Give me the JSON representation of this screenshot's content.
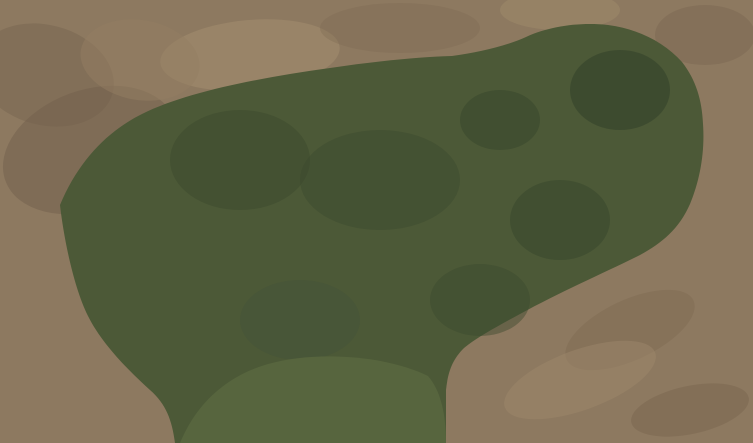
{
  "scene_meta": {
    "description": "aerial-drone-photo-of-landscaped-estate",
    "width": 753,
    "height": 443
  },
  "palette": {
    "dirt_base": "#8d7960",
    "dirt_light": "#9c8a72",
    "dirt_dark": "#6f5d4b",
    "dirt_road": "#948062",
    "dirt_track": "#a8926f",
    "estate_green": "#4c5937",
    "lawn_light": "#57653e",
    "scrub_dark": "#4f5140",
    "hedge": "#2b3b25",
    "tree_dark": "#33462b",
    "tree_mid": "#42582f",
    "tree_olive": "#6b7548",
    "shrub_bare": "#84765f",
    "tall_grass": "#b2a277",
    "tall_grass_light": "#d3c79c",
    "water": "#3a444e",
    "water_deep": "#313a43",
    "cascade_blue": "#8fb3cc",
    "stone_path": "#c8cdd2",
    "stone_white": "#e9ebed",
    "paving_gray": "#a7adb4",
    "flower_pink": "#c2447e",
    "pavilion_navy": "#1b2341",
    "pavilion_rib": "#2a3560",
    "cream_roof": "#e9e2d0",
    "cream_parapet": "#f2efe6",
    "cream_shadow": "#5a4038",
    "play_blue": "#3a79b8",
    "play_green": "#3f9a5f",
    "play_red": "#bf4038",
    "play_salmon": "#dd8a6d",
    "play_teal": "#1f6f74",
    "track_blue": "#7b90a8",
    "track_edge": "#d8dde2",
    "villa_roof": "#49525c",
    "villa_roof_hip": "#6a7581",
    "villa_border": "#dcdfe2",
    "villa_tan": "#cfc3a6",
    "villa_glass": "#a8c8dc",
    "bigroof_a": "#566779",
    "bigroof_b": "#73859a",
    "bigroof_c": "#5d6e82",
    "facade": "#3a4a5c",
    "window_glass": "#7c96aa",
    "canopy_glass": "#54738c",
    "house_roof": "#535d66",
    "house_ridge": "#76828c",
    "court_pave": "#c6cacf",
    "court_alt": "#b2b8bf",
    "asphalt": "#45494d",
    "curb": "#c9cccd",
    "parking_gray": "#8e9092",
    "spa_dark": "#25424a",
    "teal_paint": "#3aa08a",
    "white": "#ffffff"
  },
  "scene": {
    "bushes": [
      [
        175,
        100,
        8,
        "d"
      ],
      [
        192,
        88,
        6,
        "b"
      ],
      [
        210,
        95,
        9,
        "m"
      ],
      [
        228,
        82,
        7,
        "d"
      ],
      [
        246,
        92,
        8,
        "b"
      ],
      [
        262,
        80,
        7,
        "m"
      ],
      [
        280,
        88,
        8,
        "d"
      ],
      [
        298,
        78,
        6,
        "b"
      ],
      [
        315,
        85,
        7,
        "m"
      ],
      [
        332,
        76,
        6,
        "d"
      ],
      [
        350,
        84,
        8,
        "b"
      ],
      [
        368,
        70,
        7,
        "m"
      ],
      [
        385,
        80,
        6,
        "d"
      ],
      [
        402,
        72,
        7,
        "b"
      ],
      [
        418,
        78,
        6,
        "m"
      ],
      [
        433,
        70,
        5,
        "d"
      ],
      [
        448,
        64,
        6,
        "b"
      ],
      [
        460,
        72,
        6,
        "m"
      ],
      [
        415,
        96,
        7,
        "o"
      ],
      [
        396,
        101,
        6,
        "d"
      ],
      [
        425,
        107,
        7,
        "m"
      ],
      [
        512,
        54,
        8,
        "d"
      ],
      [
        498,
        44,
        6,
        "m"
      ],
      [
        532,
        44,
        7,
        "d"
      ],
      [
        548,
        36,
        9,
        "d"
      ],
      [
        568,
        29,
        7,
        "m"
      ],
      [
        590,
        31,
        9,
        "d"
      ],
      [
        615,
        30,
        7,
        "m"
      ],
      [
        640,
        38,
        8,
        "d"
      ],
      [
        663,
        52,
        9,
        "m"
      ],
      [
        682,
        68,
        8,
        "d"
      ],
      [
        694,
        90,
        8,
        "m"
      ],
      [
        700,
        112,
        7,
        "d"
      ],
      [
        585,
        60,
        9,
        "d"
      ],
      [
        612,
        52,
        7,
        "m"
      ],
      [
        650,
        58,
        8,
        "d"
      ],
      [
        673,
        95,
        8,
        "m"
      ],
      [
        668,
        124,
        7,
        "d"
      ],
      [
        600,
        140,
        8,
        "m"
      ],
      [
        577,
        126,
        7,
        "d"
      ],
      [
        563,
        100,
        7,
        "m"
      ],
      [
        571,
        76,
        7,
        "b"
      ],
      [
        702,
        150,
        8,
        "o"
      ],
      [
        714,
        170,
        7,
        "d"
      ],
      [
        700,
        214,
        9,
        "m"
      ],
      [
        674,
        238,
        8,
        "d"
      ],
      [
        646,
        252,
        7,
        "m"
      ],
      [
        612,
        256,
        8,
        "d"
      ],
      [
        586,
        264,
        7,
        "m"
      ],
      [
        588,
        176,
        7,
        "d"
      ],
      [
        596,
        200,
        6,
        "m"
      ],
      [
        601,
        224,
        7,
        "d"
      ],
      [
        449,
        150,
        7,
        "m"
      ],
      [
        441,
        176,
        8,
        "d"
      ],
      [
        446,
        202,
        7,
        "m"
      ],
      [
        453,
        226,
        7,
        "d"
      ],
      [
        471,
        251,
        8,
        "d"
      ],
      [
        496,
        263,
        7,
        "m"
      ],
      [
        521,
        271,
        8,
        "d"
      ],
      [
        547,
        279,
        7,
        "m"
      ],
      [
        472,
        291,
        9,
        "d"
      ],
      [
        501,
        296,
        8,
        "m"
      ],
      [
        531,
        301,
        7,
        "d"
      ],
      [
        556,
        290,
        7,
        "m"
      ],
      [
        215,
        350,
        9,
        "d"
      ],
      [
        240,
        366,
        7,
        "m"
      ],
      [
        226,
        396,
        8,
        "o"
      ],
      [
        252,
        421,
        9,
        "d"
      ],
      [
        302,
        401,
        6,
        "m"
      ],
      [
        322,
        381,
        5,
        "d"
      ],
      [
        210,
        431,
        7,
        "m"
      ],
      [
        266,
        391,
        6,
        "d"
      ],
      [
        152,
        150,
        7,
        "m"
      ],
      [
        136,
        170,
        6,
        "d"
      ],
      [
        252,
        120,
        8,
        "m"
      ],
      [
        272,
        108,
        6,
        "d"
      ],
      [
        462,
        321,
        8,
        "d"
      ],
      [
        442,
        341,
        7,
        "m"
      ],
      [
        466,
        346,
        6,
        "o"
      ],
      [
        486,
        330,
        7,
        "d"
      ],
      [
        286,
        346,
        6,
        "d"
      ],
      [
        311,
        351,
        5,
        "m"
      ],
      [
        334,
        340,
        5,
        "d"
      ],
      [
        706,
        60,
        7,
        "b"
      ],
      [
        722,
        200,
        6,
        "d"
      ],
      [
        736,
        90,
        6,
        "b"
      ]
    ],
    "flowers": [
      [
        173,
        168
      ],
      [
        168,
        182
      ],
      [
        171,
        196
      ],
      [
        179,
        210
      ],
      [
        191,
        222
      ],
      [
        205,
        230
      ],
      [
        220,
        234
      ],
      [
        293,
        197
      ],
      [
        301,
        209
      ],
      [
        309,
        221
      ],
      [
        316,
        231
      ],
      [
        252,
        228
      ],
      [
        263,
        235
      ],
      [
        346,
        148
      ],
      [
        353,
        156
      ],
      [
        429,
        92
      ],
      [
        437,
        98
      ],
      [
        301,
        239
      ],
      [
        287,
        243
      ],
      [
        409,
        227
      ],
      [
        417,
        233
      ],
      [
        238,
        131
      ],
      [
        230,
        142
      ]
    ],
    "rocks": [
      [
        196,
        146
      ],
      [
        210,
        140
      ],
      [
        226,
        138
      ],
      [
        244,
        144
      ],
      [
        258,
        152
      ],
      [
        266,
        166
      ],
      [
        262,
        180
      ],
      [
        268,
        196
      ],
      [
        272,
        212
      ],
      [
        258,
        224
      ],
      [
        240,
        230
      ],
      [
        222,
        230
      ],
      [
        206,
        224
      ],
      [
        192,
        214
      ],
      [
        186,
        198
      ],
      [
        184,
        182
      ],
      [
        305,
        130
      ],
      [
        322,
        124
      ],
      [
        340,
        126
      ],
      [
        358,
        130
      ],
      [
        376,
        136
      ],
      [
        394,
        142
      ],
      [
        410,
        148
      ],
      [
        424,
        158
      ],
      [
        432,
        172
      ],
      [
        428,
        186
      ],
      [
        414,
        196
      ],
      [
        398,
        206
      ],
      [
        380,
        214
      ],
      [
        362,
        218
      ],
      [
        344,
        220
      ],
      [
        328,
        212
      ],
      [
        316,
        200
      ],
      [
        308,
        188
      ],
      [
        300,
        172
      ],
      [
        298,
        156
      ],
      [
        352,
        168
      ],
      [
        368,
        180
      ],
      [
        340,
        186
      ],
      [
        330,
        158
      ]
    ],
    "dirt_streaks": [
      [
        480,
        420,
        560,
        386
      ],
      [
        500,
        432,
        590,
        396
      ],
      [
        530,
        438,
        620,
        404
      ],
      [
        560,
        440,
        650,
        412
      ],
      [
        600,
        436,
        680,
        408
      ],
      [
        640,
        430,
        710,
        402
      ],
      [
        520,
        360,
        470,
        396
      ],
      [
        680,
        280,
        620,
        320
      ],
      [
        700,
        300,
        640,
        340
      ],
      [
        660,
        330,
        720,
        296
      ]
    ],
    "blotches": [
      [
        90,
        150,
        90,
        60,
        -20,
        "#6f5d4b",
        0.45
      ],
      [
        45,
        75,
        70,
        50,
        15,
        "#74614d",
        0.4
      ],
      [
        250,
        55,
        90,
        35,
        -5,
        "#a5906f",
        0.5
      ],
      [
        400,
        28,
        80,
        25,
        0,
        "#7e6b52",
        0.35
      ],
      [
        560,
        10,
        60,
        20,
        0,
        "#a5906f",
        0.4
      ],
      [
        705,
        35,
        50,
        30,
        0,
        "#75624c",
        0.35
      ],
      [
        630,
        330,
        70,
        30,
        -25,
        "#7c6951",
        0.4
      ],
      [
        580,
        380,
        80,
        30,
        -20,
        "#a08a6c",
        0.45
      ],
      [
        690,
        410,
        60,
        24,
        -12,
        "#75624c",
        0.4
      ],
      [
        140,
        60,
        60,
        40,
        10,
        "#937e61",
        0.5
      ]
    ],
    "green_shadows": [
      [
        240,
        160,
        70,
        50,
        "#3c4a2e",
        0.5
      ],
      [
        380,
        180,
        80,
        50,
        "#3c4a2e",
        0.45
      ],
      [
        500,
        120,
        40,
        30,
        "#36452c",
        0.5
      ],
      [
        620,
        90,
        50,
        40,
        "#31402a",
        0.55
      ],
      [
        560,
        220,
        50,
        40,
        "#36452c",
        0.5
      ],
      [
        300,
        320,
        60,
        40,
        "#44523a",
        0.4
      ],
      [
        480,
        300,
        50,
        36,
        "#3c4a2e",
        0.45
      ]
    ],
    "cars": [
      {
        "x": 112,
        "y": 137,
        "a": -38,
        "c": "#eef1f2"
      },
      {
        "x": 131,
        "y": 148,
        "a": -38,
        "c": "#e8ebec"
      }
    ],
    "teal_marks": [
      [
        138,
        420,
        20
      ],
      [
        150,
        428,
        -10
      ],
      [
        163,
        418,
        30
      ],
      [
        147,
        436,
        0
      ],
      [
        370,
        433,
        -15
      ]
    ],
    "grass_streaks": [
      [
        80,
        250,
        130,
        180
      ],
      [
        95,
        270,
        150,
        200
      ],
      [
        110,
        295,
        165,
        230
      ],
      [
        130,
        315,
        180,
        258
      ],
      [
        150,
        330,
        195,
        282
      ],
      [
        75,
        225,
        115,
        165
      ]
    ],
    "cascades": [
      [
        362,
        196,
        372,
        188
      ],
      [
        374,
        208,
        384,
        200
      ],
      [
        386,
        220,
        396,
        212
      ]
    ]
  }
}
